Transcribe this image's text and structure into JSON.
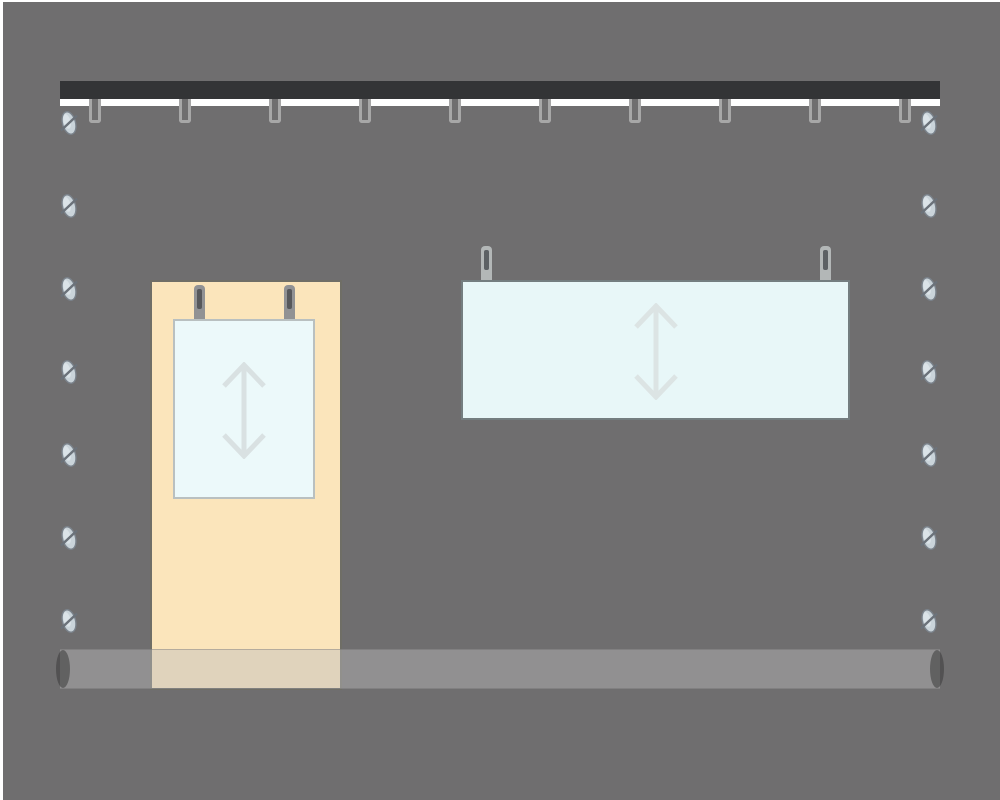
{
  "canvas": {
    "width": 1000,
    "height": 800,
    "page_background": "#ffffff"
  },
  "wall": {
    "x": 3,
    "y": 2,
    "width": 997,
    "height": 798,
    "color": "#6f6e6f"
  },
  "top_rail": {
    "x": 60,
    "y": 81,
    "width": 880,
    "bar_height": 18,
    "bar_color": "#333436",
    "strip_height": 7,
    "strip_color": "#ffffff",
    "hooks": {
      "count": 10,
      "first_center_x": 95,
      "spacing_x": 90,
      "top_y": 99,
      "width": 12,
      "height": 24,
      "stroke_width": 3,
      "stroke_color": "#a7a7a7",
      "fill_color": "#6f6e6f",
      "corner_radius": 3
    }
  },
  "screws": {
    "rows": 7,
    "first_center_y": 123,
    "spacing_y": 83,
    "left_center_x": 69,
    "right_center_x": 929,
    "body_width": 13,
    "body_height": 23,
    "tilt_deg": -15,
    "fill": "#cad4da",
    "highlight": "#e2eaee",
    "stroke": "#7b838c",
    "slot_color": "#6b727a"
  },
  "backer_panel": {
    "x": 150,
    "y": 280,
    "width": 192,
    "height": 410,
    "fill": "#fbe5bb",
    "border_color": "#6f6e66",
    "border_width": 2
  },
  "poster": {
    "x": 173,
    "y": 319,
    "width": 142,
    "height": 180,
    "fill": "#ecf9fa",
    "border_color": "#b9c0c0",
    "border_width": 2,
    "clips": {
      "centers_x": [
        199,
        289
      ],
      "top_y": 285,
      "width": 11,
      "height": 34,
      "body_color": "#919294",
      "slot_color": "#57585b",
      "slot_width": 5,
      "slot_height": 20,
      "slot_top": 4
    },
    "arrow": {
      "center_x": 244,
      "top_y": 362,
      "width": 46,
      "height": 97,
      "color": "#d9e1e2",
      "stroke_width": 5,
      "meaning": "adjustable-height"
    }
  },
  "wide_sign": {
    "x": 461,
    "y": 280,
    "width": 389,
    "height": 140,
    "fill": "#e8f7f8",
    "border_color": "#747e80",
    "border_width": 2,
    "clips": {
      "centers_x": [
        486,
        825
      ],
      "top_y": 246,
      "width": 11,
      "height": 34,
      "body_color": "#b3b7b7",
      "slot_color": "#5d6164",
      "slot_width": 5,
      "slot_height": 20,
      "slot_top": 4
    },
    "arrow": {
      "center_x": 656,
      "top_y": 303,
      "width": 46,
      "height": 97,
      "color": "#dce4e4",
      "stroke_width": 5,
      "meaning": "adjustable-height"
    }
  },
  "bottom_rod": {
    "x": 60,
    "y": 649,
    "width": 880,
    "height": 40,
    "fill": "rgba(190,190,190,0.44)",
    "edge_color": "rgba(100,100,100,0.35)",
    "cap_color": "rgba(58,58,58,0.55)",
    "cap_width": 14,
    "cap_height": 38,
    "cap_centers_x": [
      63,
      937
    ]
  }
}
